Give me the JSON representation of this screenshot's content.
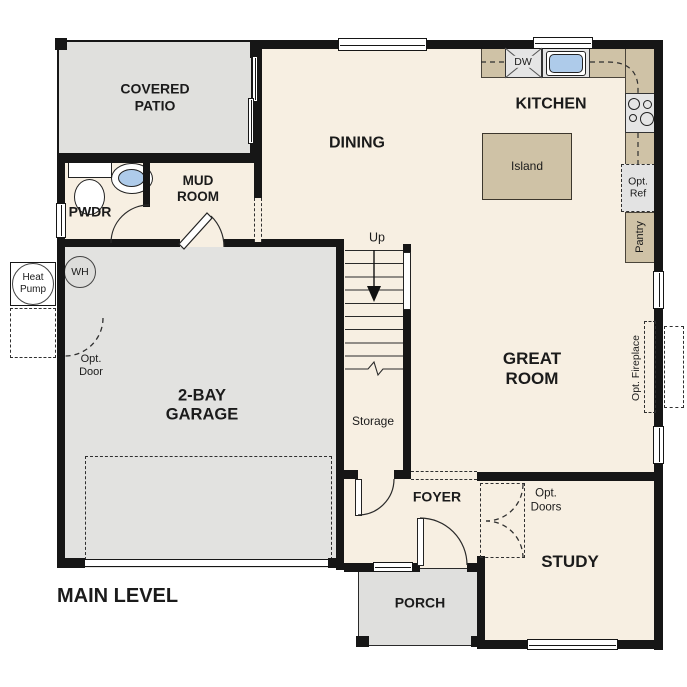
{
  "plan_title": "MAIN LEVEL",
  "colors": {
    "wall": "#161616",
    "floor_cream": "#f7efe2",
    "outdoor_gray": "#e0e0dd",
    "garage_gray": "#e2e2e0",
    "counter_tan": "#cfc2a6",
    "appliance_gray": "#e5e5e5",
    "water_blue": "#aecbea"
  },
  "rooms": {
    "covered_patio": "COVERED\nPATIO",
    "dining": "DINING",
    "kitchen": "KITCHEN",
    "mud_room": "MUD\nROOM",
    "pwdr": "PWDR",
    "great_room": "GREAT\nROOM",
    "garage": "2-BAY\nGARAGE",
    "foyer": "FOYER",
    "study": "STUDY",
    "porch": "PORCH",
    "storage": "Storage",
    "pantry": "Pantry",
    "island": "Island"
  },
  "annotations": {
    "up": "Up",
    "dw": "DW",
    "wh": "WH",
    "heat_pump": "Heat\nPump",
    "opt_ref": "Opt.\nRef",
    "opt_door": "Opt.\nDoor",
    "opt_doors": "Opt.\nDoors",
    "opt_fireplace": "Opt. Fireplace"
  }
}
